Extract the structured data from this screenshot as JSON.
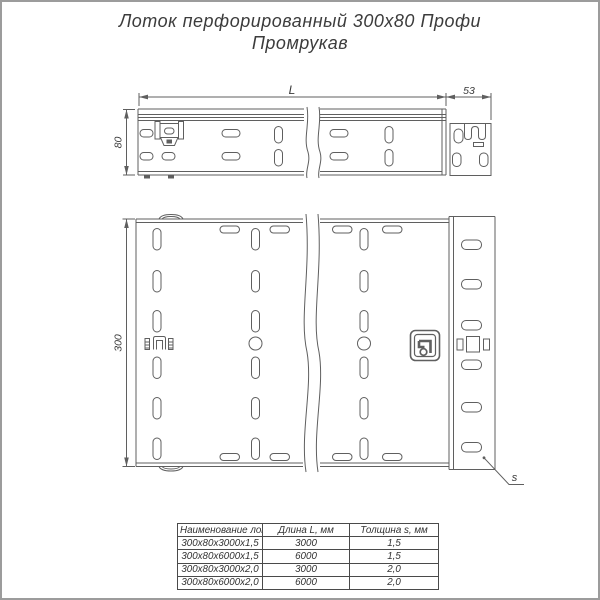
{
  "title": {
    "line1": "Лоток перфорированный 300х80 Профи",
    "line2": "Промрукав"
  },
  "dimensions": {
    "length": "L",
    "end_section_width": "53",
    "side_height": "80",
    "tray_width": "300",
    "thickness": "s"
  },
  "table": {
    "headers": [
      "Наименование лотка",
      "Длина L, мм",
      "Толщина s, мм"
    ],
    "rows": [
      [
        "300х80х3000х1,5",
        "3000",
        "1,5"
      ],
      [
        "300х80х6000х1,5",
        "6000",
        "1,5"
      ],
      [
        "300х80х3000х2,0",
        "3000",
        "2,0"
      ],
      [
        "300х80х6000х2,0",
        "6000",
        "2,0"
      ]
    ]
  },
  "colors": {
    "line": "#5f5f5f",
    "text": "#3a3a3a",
    "page_border": "#9c9c9c"
  }
}
